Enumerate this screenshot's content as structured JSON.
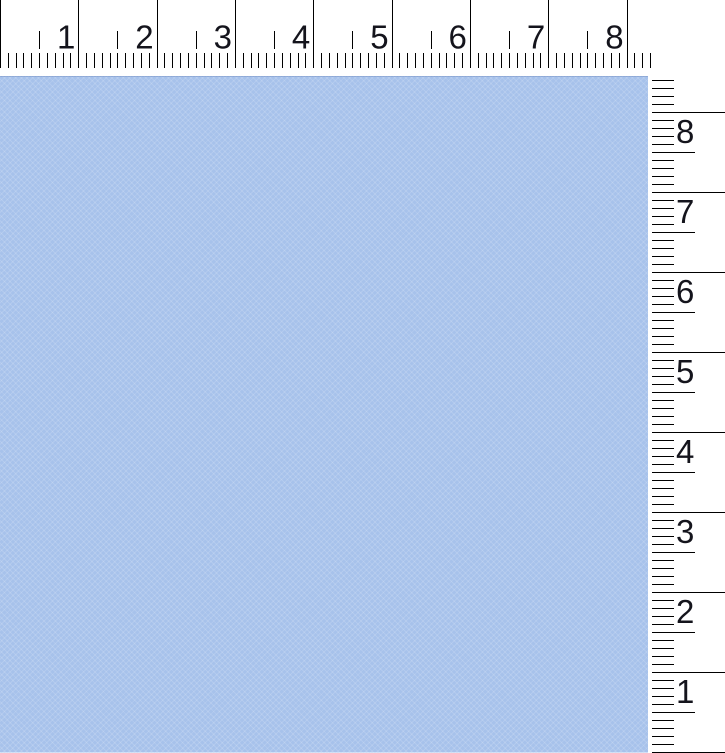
{
  "app": {
    "name": "screen-ruler-overlay"
  },
  "canvas": {
    "color": "#a7c2eb"
  },
  "rulers": {
    "background": "#ffffff",
    "tick_color": "#000000",
    "label_color": "#14141c",
    "horizontal": {
      "labels": [
        "1",
        "2",
        "3",
        "4",
        "5",
        "6",
        "7",
        "8"
      ],
      "px_per_unit": 78.32,
      "minor_per_unit": 10,
      "length_px": 651,
      "major_tick": {
        "y1": 0,
        "y2": 68
      },
      "medium_tick": {
        "y1": 31,
        "y2": 49
      },
      "minor_tick": {
        "y1": 53,
        "y2": 68
      },
      "label_baseline_y": 48.5,
      "label_gap_px": 3
    },
    "vertical": {
      "labels": [
        "8",
        "7",
        "6",
        "5",
        "4",
        "3",
        "2",
        "1"
      ],
      "px_per_unit": 80,
      "minor_per_unit": 10,
      "origin_px": 752,
      "top_limit_px": 79,
      "major_tick": {
        "x1": 652,
        "x2": 725
      },
      "medium_tick": {
        "x1": 652,
        "x2": 695
      },
      "minor_tick": {
        "x1": 652,
        "x2": 674
      },
      "label_x": 676,
      "label_baseline_offset": 31
    }
  }
}
